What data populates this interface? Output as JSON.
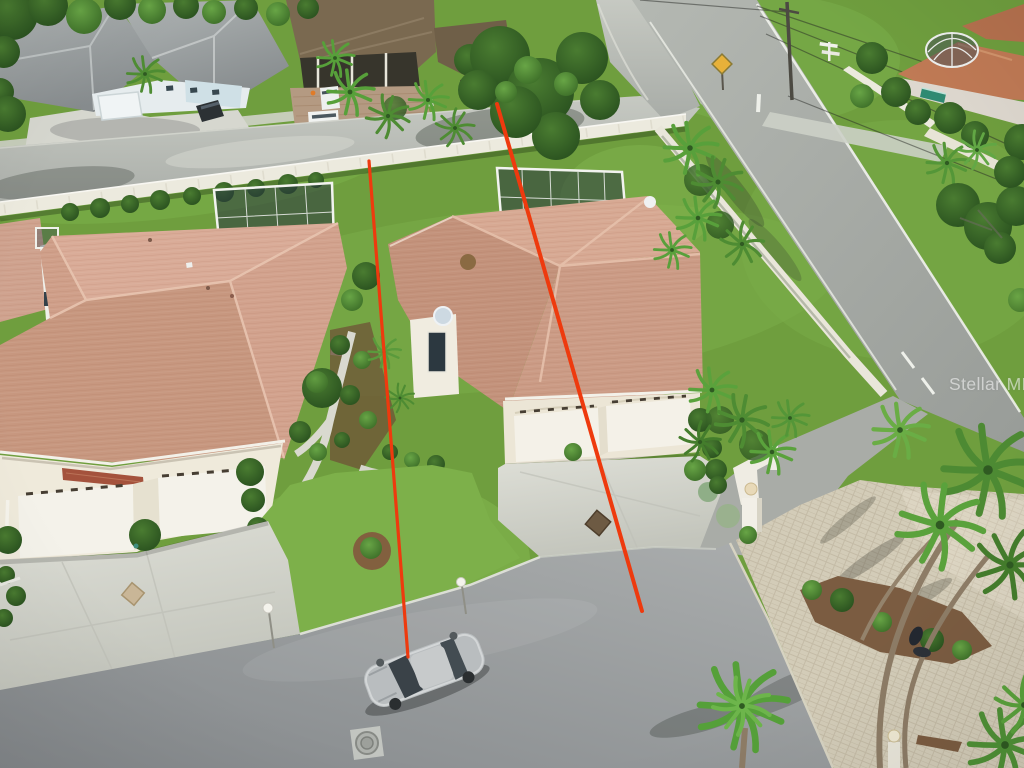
{
  "photo": {
    "kind": "aerial-drone-listing-photo",
    "watermark": {
      "text": "Stellar MLS",
      "color": "rgba(255,255,255,0.55)"
    },
    "annotation": {
      "color": "#ee3a0e",
      "lines": [
        {
          "name": "boundary-line-left",
          "x1": 369,
          "y1": 161,
          "x2": 408,
          "y2": 657,
          "width": 3.2
        },
        {
          "name": "boundary-line-right",
          "x1": 497,
          "y1": 104,
          "x2": 642,
          "y2": 611,
          "width": 4
        }
      ]
    },
    "palette": {
      "grass": "#6f9e3e",
      "lawn_bright": "#7db04a",
      "roof_salmon": "#cfa18c",
      "roof_gray": "#9ba0a1",
      "road_upper": "#b5b9b3",
      "road_diagonal": "#a4a8a4",
      "street": "#9aa0a1",
      "concrete": "#d2d3cb",
      "pavers": "#d0c9b5",
      "fence": "#eceade"
    }
  }
}
